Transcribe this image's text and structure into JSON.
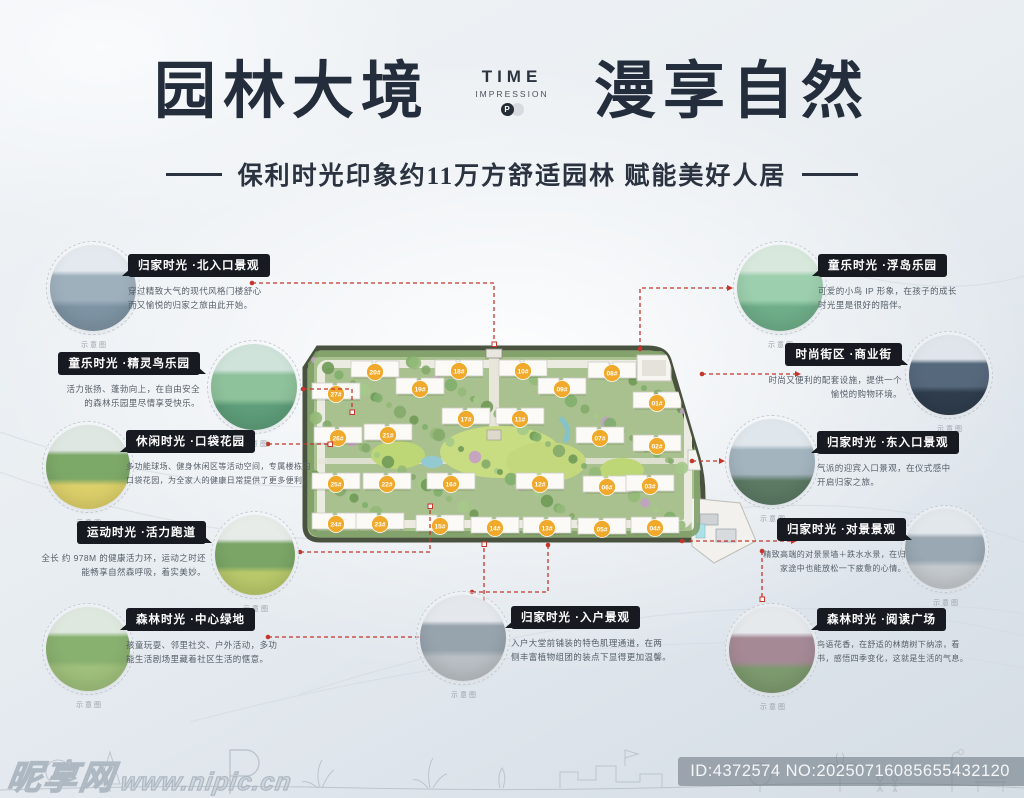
{
  "header": {
    "title_left": "园林大境",
    "title_right": "漫享自然",
    "logo": {
      "line1": "TIME",
      "line2": "IMPRESSION",
      "badge_letter": "P"
    },
    "subtitle": "保利时光印象约11万方舒适园林 赋能美好人居"
  },
  "callouts": [
    {
      "id": "north-entrance",
      "label": "归家时光 ·北入口景观",
      "desc": "穿过精致大气的现代风格门楼舒心\n而又愉悦的归家之旅由此开始。",
      "caption": "示意图",
      "photo": [
        "#e3e9ee",
        "#9fb0bd",
        "#7e94a4"
      ]
    },
    {
      "id": "spirit-bird-park",
      "label": "童乐时光 ·精灵鸟乐园",
      "desc": "活力张扬、蓬勃向上，在自由安全\n的森林乐园里尽情享受快乐。",
      "caption": "示意图",
      "photo": [
        "#cfe3da",
        "#8ec29b",
        "#5e9e7a"
      ]
    },
    {
      "id": "pocket-garden",
      "label": "休闲时光 ·口袋花园",
      "desc": "多功能球场、健身休闲区等活动空间，专属楼栋的\n口袋花园，为全家人的健康日常提供了更多便利。",
      "caption": "示意图",
      "photo": [
        "#dfe7e3",
        "#7ca868",
        "#ddd06a"
      ]
    },
    {
      "id": "vitality-track",
      "label": "运动时光 ·活力跑道",
      "desc": "全长 约 978M 的健康活力环，运动之时还\n能畅享自然森呼吸，着实美妙。",
      "caption": "示意图",
      "photo": [
        "#e8ece9",
        "#7aa566",
        "#b9c96a"
      ]
    },
    {
      "id": "central-green",
      "label": "森林时光 ·中心绿地",
      "desc": "孩童玩耍、邻里社交、户外活动，多功\n能生活剧场里藏着社区生活的惬意。",
      "caption": "示意图",
      "photo": [
        "#dfe8df",
        "#88b06f",
        "#9fc07c"
      ]
    },
    {
      "id": "floating-island-park",
      "label": "童乐时光 ·浮岛乐园",
      "desc": "可爱的小鸟 IP 形象，在孩子的成长\n时光里是很好的陪伴。",
      "caption": "示意图",
      "photo": [
        "#d8e8dc",
        "#9ccfae",
        "#6fae89"
      ]
    },
    {
      "id": "commercial-street",
      "label": "时尚街区 ·商业街",
      "desc": "时尚又便利的配套设施，提供一个\n愉悦的购物环境。",
      "caption": "示意图",
      "photo": [
        "#dfe5ea",
        "#56687c",
        "#2f3d4d"
      ]
    },
    {
      "id": "east-entrance",
      "label": "归家时光 ·东入口景观",
      "desc": "气派的迎宾入口景观，在仪式感中\n开启归家之旅。",
      "caption": "示意图",
      "photo": [
        "#dfe7ed",
        "#a3b4bf",
        "#5c7a64"
      ]
    },
    {
      "id": "framed-view",
      "label": "归家时光 ·对景景观",
      "desc": "精致高端的对景景墙＋跌水水景，在归\n家途中也能放松一下疲惫的心情。",
      "caption": "示意图",
      "photo": [
        "#e2e7ec",
        "#9aa8b3",
        "#c4c9cd"
      ]
    },
    {
      "id": "reading-plaza",
      "label": "森林时光 ·阅读广场",
      "desc": "鸟语花香，在舒适的林荫树下纳凉，看\n书，感悟四季变化，这就是生活的气息。",
      "caption": "示意图",
      "photo": [
        "#e6e9ec",
        "#a58a96",
        "#7d9a6e"
      ]
    },
    {
      "id": "entry-landscape",
      "label": "归家时光 ·入户景观",
      "desc": "入户大堂前铺装的特色肌理通道，在两\n侧丰富植物组团的装点下显得更加温馨。",
      "caption": "示意图",
      "photo": [
        "#e4e8ec",
        "#97a3ad",
        "#b9bfc4"
      ]
    }
  ],
  "map": {
    "badge_color": "#f0a92b",
    "buildings": [
      {
        "n": "20#",
        "x": 375,
        "y": 372
      },
      {
        "n": "18#",
        "x": 459,
        "y": 371
      },
      {
        "n": "10#",
        "x": 523,
        "y": 371
      },
      {
        "n": "08#",
        "x": 612,
        "y": 373
      },
      {
        "n": "27#",
        "x": 336,
        "y": 394
      },
      {
        "n": "19#",
        "x": 420,
        "y": 389
      },
      {
        "n": "09#",
        "x": 562,
        "y": 389
      },
      {
        "n": "01#",
        "x": 657,
        "y": 403
      },
      {
        "n": "26#",
        "x": 338,
        "y": 438
      },
      {
        "n": "21#",
        "x": 388,
        "y": 435
      },
      {
        "n": "17#",
        "x": 466,
        "y": 419
      },
      {
        "n": "11#",
        "x": 520,
        "y": 419
      },
      {
        "n": "07#",
        "x": 600,
        "y": 438
      },
      {
        "n": "02#",
        "x": 657,
        "y": 446
      },
      {
        "n": "25#",
        "x": 336,
        "y": 484
      },
      {
        "n": "22#",
        "x": 387,
        "y": 484
      },
      {
        "n": "16#",
        "x": 451,
        "y": 484
      },
      {
        "n": "12#",
        "x": 540,
        "y": 484
      },
      {
        "n": "06#",
        "x": 607,
        "y": 487
      },
      {
        "n": "03#",
        "x": 650,
        "y": 486
      },
      {
        "n": "24#",
        "x": 336,
        "y": 524
      },
      {
        "n": "23#",
        "x": 380,
        "y": 524
      },
      {
        "n": "15#",
        "x": 440,
        "y": 526
      },
      {
        "n": "14#",
        "x": 495,
        "y": 528
      },
      {
        "n": "13#",
        "x": 547,
        "y": 528
      },
      {
        "n": "05#",
        "x": 602,
        "y": 529
      },
      {
        "n": "04#",
        "x": 655,
        "y": 528
      }
    ]
  },
  "watermark": {
    "site_name": "昵享网",
    "site_url": "www.nipic.cn"
  },
  "footer_id": "ID:4372574 NO:20250716085655432120"
}
